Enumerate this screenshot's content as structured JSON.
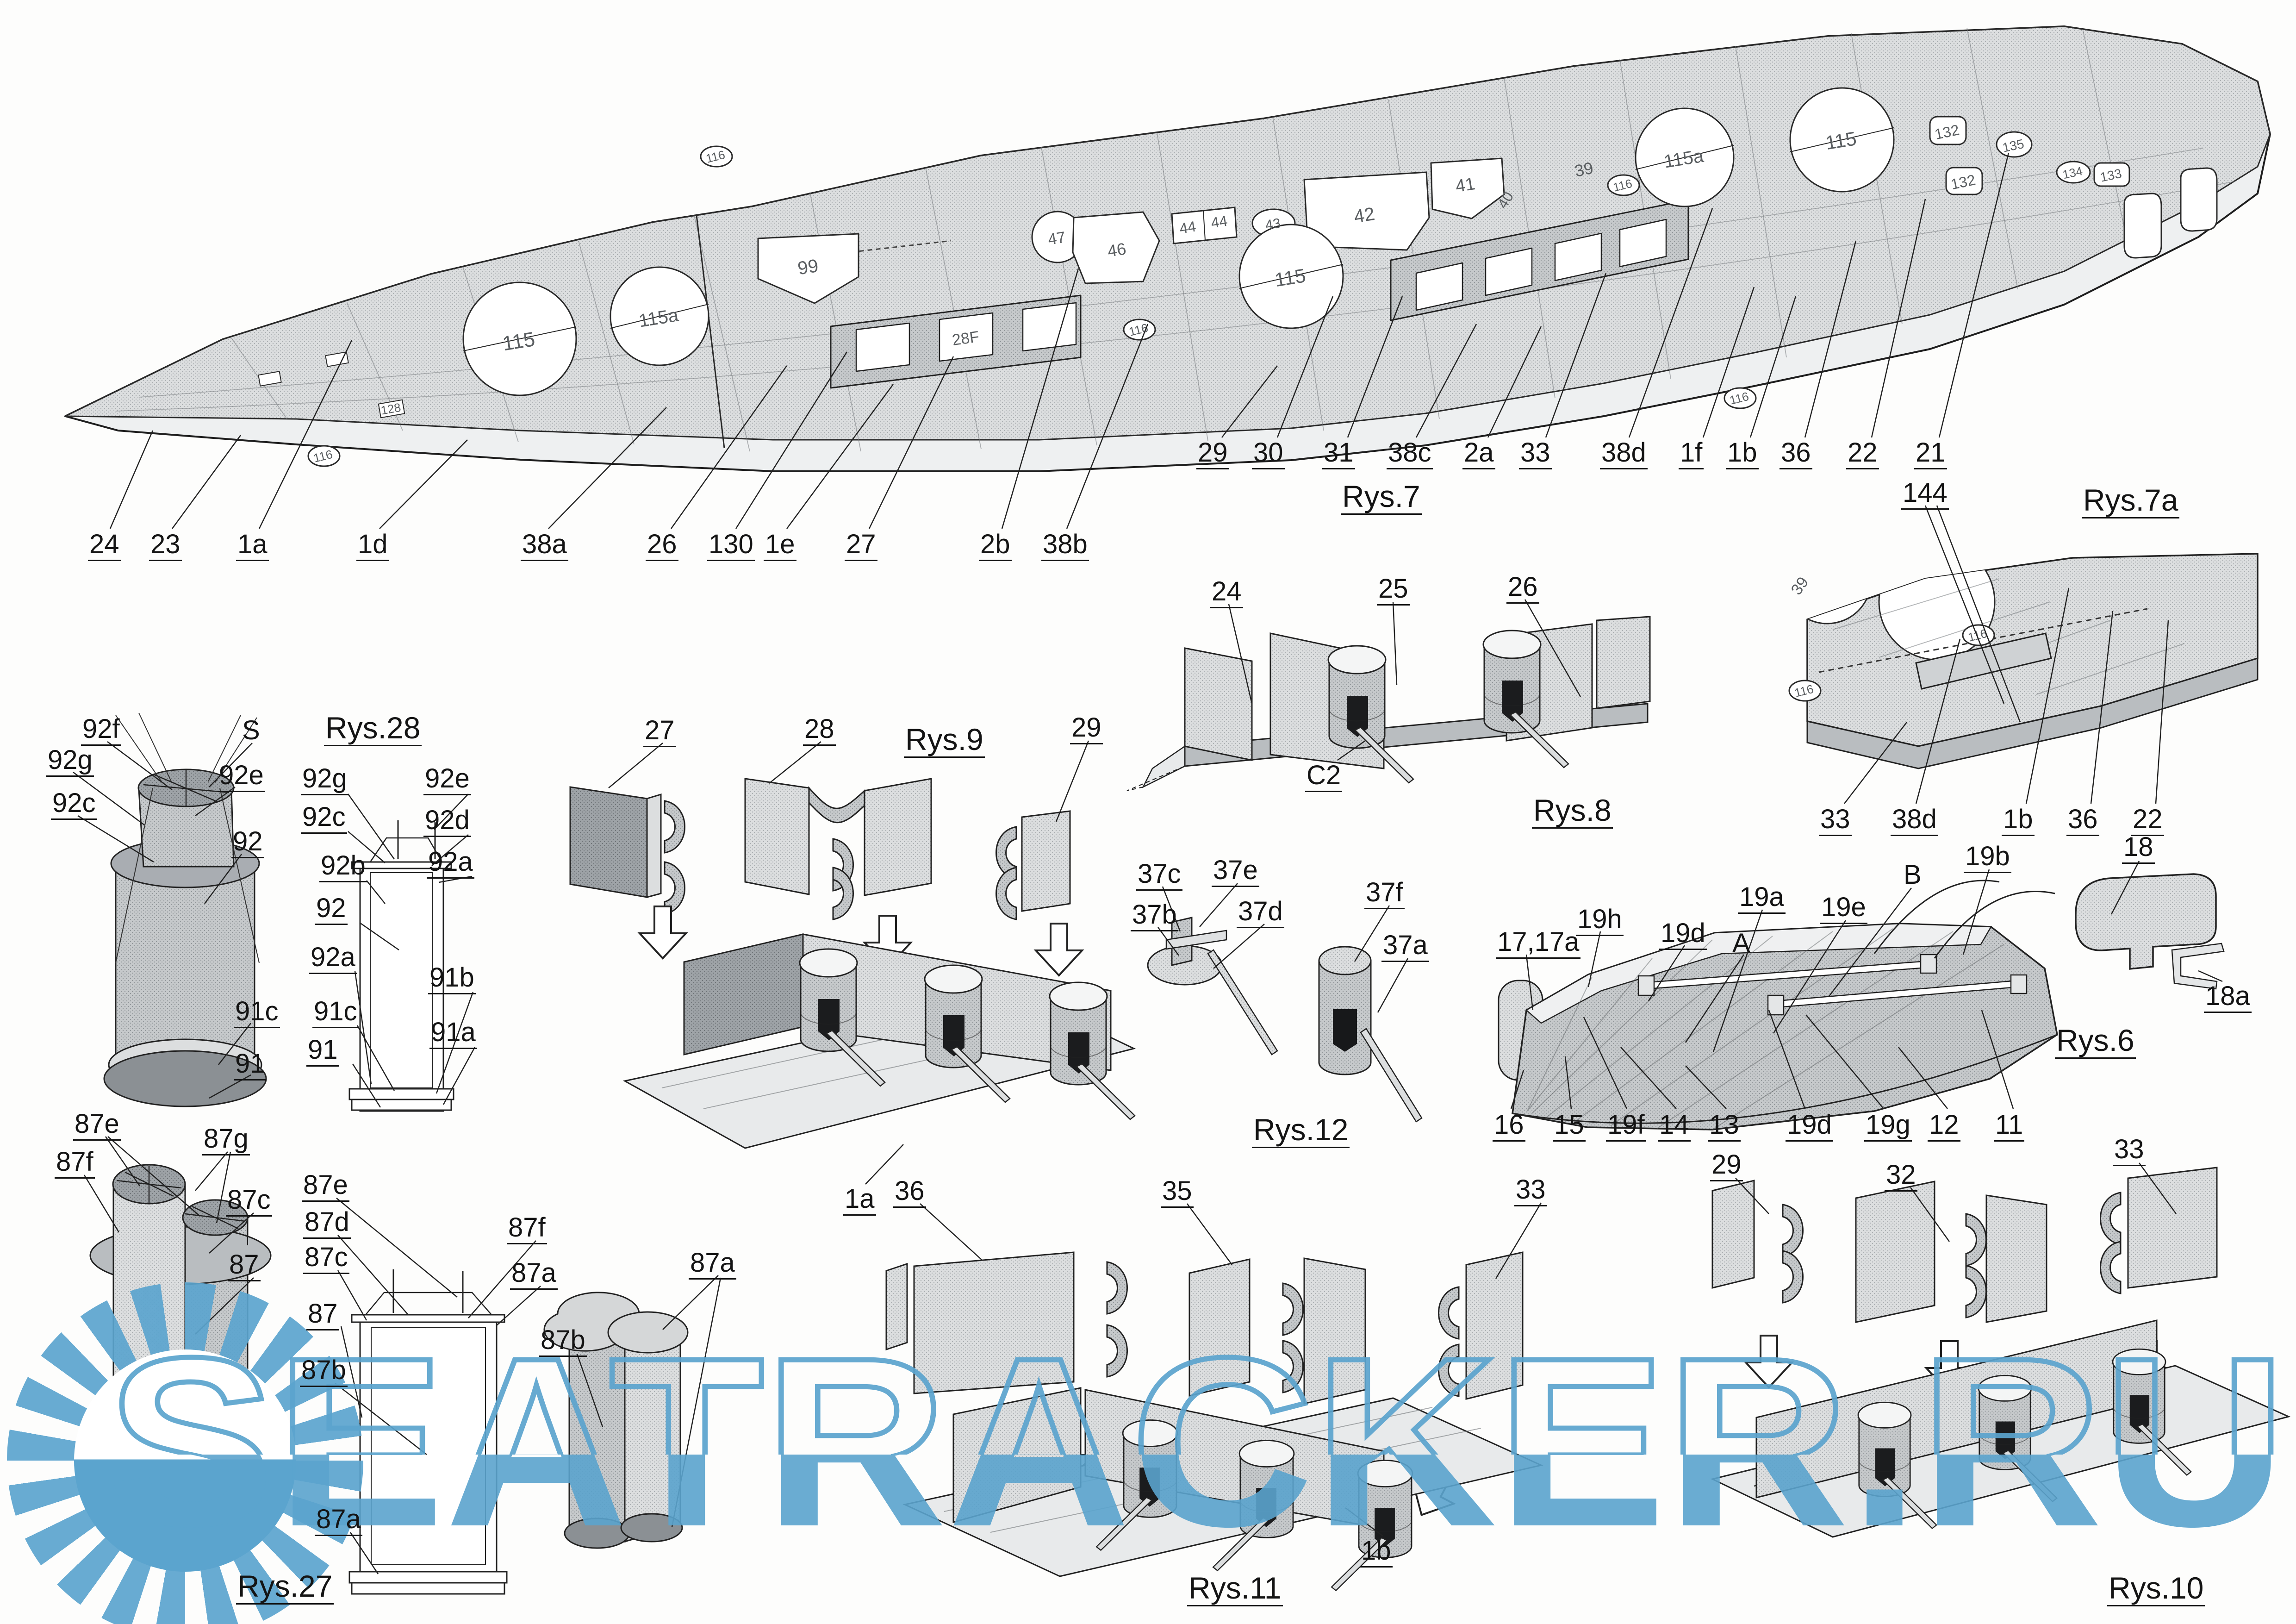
{
  "watermark": {
    "text": "SEATRACKER.RU",
    "color": "#5ba4ce",
    "icon": "sun-logo"
  },
  "fig7": {
    "title": "Rys.7",
    "top": [
      "29",
      "30",
      "31",
      "38c",
      "2a",
      "33",
      "38d",
      "1f",
      "1b",
      "36",
      "22",
      "21"
    ],
    "bottom": [
      "24",
      "23",
      "1a",
      "1d",
      "38a",
      "26",
      "130",
      "1e",
      "27",
      "2b",
      "38b"
    ],
    "deck": {
      "c115_bow": "115",
      "c115a_bow": "115a",
      "p99": "99",
      "c47": "47",
      "p46": "46",
      "p44a": "44",
      "p44b": "44",
      "o43": "43",
      "p42": "42",
      "p41": "41",
      "c115_mid": "115",
      "c115a_aft": "115a",
      "c115_aft": "115",
      "l39": "39",
      "l40": "40",
      "m132a": "132",
      "m132b": "132",
      "m135": "135",
      "m134": "134",
      "m133": "133",
      "m128": "128",
      "casemate": "28F",
      "oval116": "116"
    }
  },
  "fig7a": {
    "title": "Rys.7a",
    "top": "144",
    "bottom": [
      "33",
      "38d",
      "1b",
      "36",
      "22"
    ],
    "deck39": "39",
    "oval116": "116"
  },
  "fig8": {
    "title": "Rys.8",
    "l24": "24",
    "l25": "25",
    "l26": "26",
    "lC2": "C2"
  },
  "fig9": {
    "title": "Rys.9",
    "p27": "27",
    "p28": "28",
    "p29": "29",
    "assembly": "1a"
  },
  "fig28": {
    "title": "Rys.28",
    "f92f": "92f",
    "fS": "S",
    "f92g": "92g",
    "f92e": "92e",
    "f92c": "92c",
    "f92": "92",
    "f91c": "91c",
    "f91": "91",
    "s92g": "92g",
    "s92c": "92c",
    "s92b": "92b",
    "s92": "92",
    "s92a_l": "92a",
    "s91c": "91c",
    "s91": "91",
    "s92e": "92e",
    "s92d": "92d",
    "s92a_r": "92a",
    "s91b": "91b",
    "s91a": "91a"
  },
  "fig12": {
    "title": "Rys.12",
    "l37c": "37c",
    "l37e": "37e",
    "l37b": "37b",
    "l37d": "37d",
    "l37f": "37f",
    "l37a": "37a"
  },
  "fig6": {
    "title": "Rys.6",
    "top": [
      "17,17a",
      "19h",
      "19d",
      "A",
      "19a",
      "19e",
      "B",
      "19b"
    ],
    "bottom": [
      "16",
      "15",
      "19f",
      "14",
      "13",
      "19d",
      "19g",
      "12",
      "11"
    ],
    "l18": "18",
    "l18a": "18a"
  },
  "fig27": {
    "title": "Rys.27",
    "f87e": "87e",
    "f87g": "87g",
    "f87f": "87f",
    "f87c": "87c",
    "f87": "87",
    "s87e": "87e",
    "s87d": "87d",
    "s87c": "87c",
    "s87": "87",
    "s87b": "87b",
    "s87f": "87f",
    "s87a": "87a",
    "s87a_b": "87a",
    "c87b": "87b",
    "c87a": "87a"
  },
  "fig11": {
    "title": "Rys.11",
    "p36": "36",
    "p35": "35",
    "p33": "33",
    "assembly": "1b"
  },
  "fig10": {
    "title": "Rys.10",
    "p29": "29",
    "p32": "32",
    "p33": "33"
  }
}
